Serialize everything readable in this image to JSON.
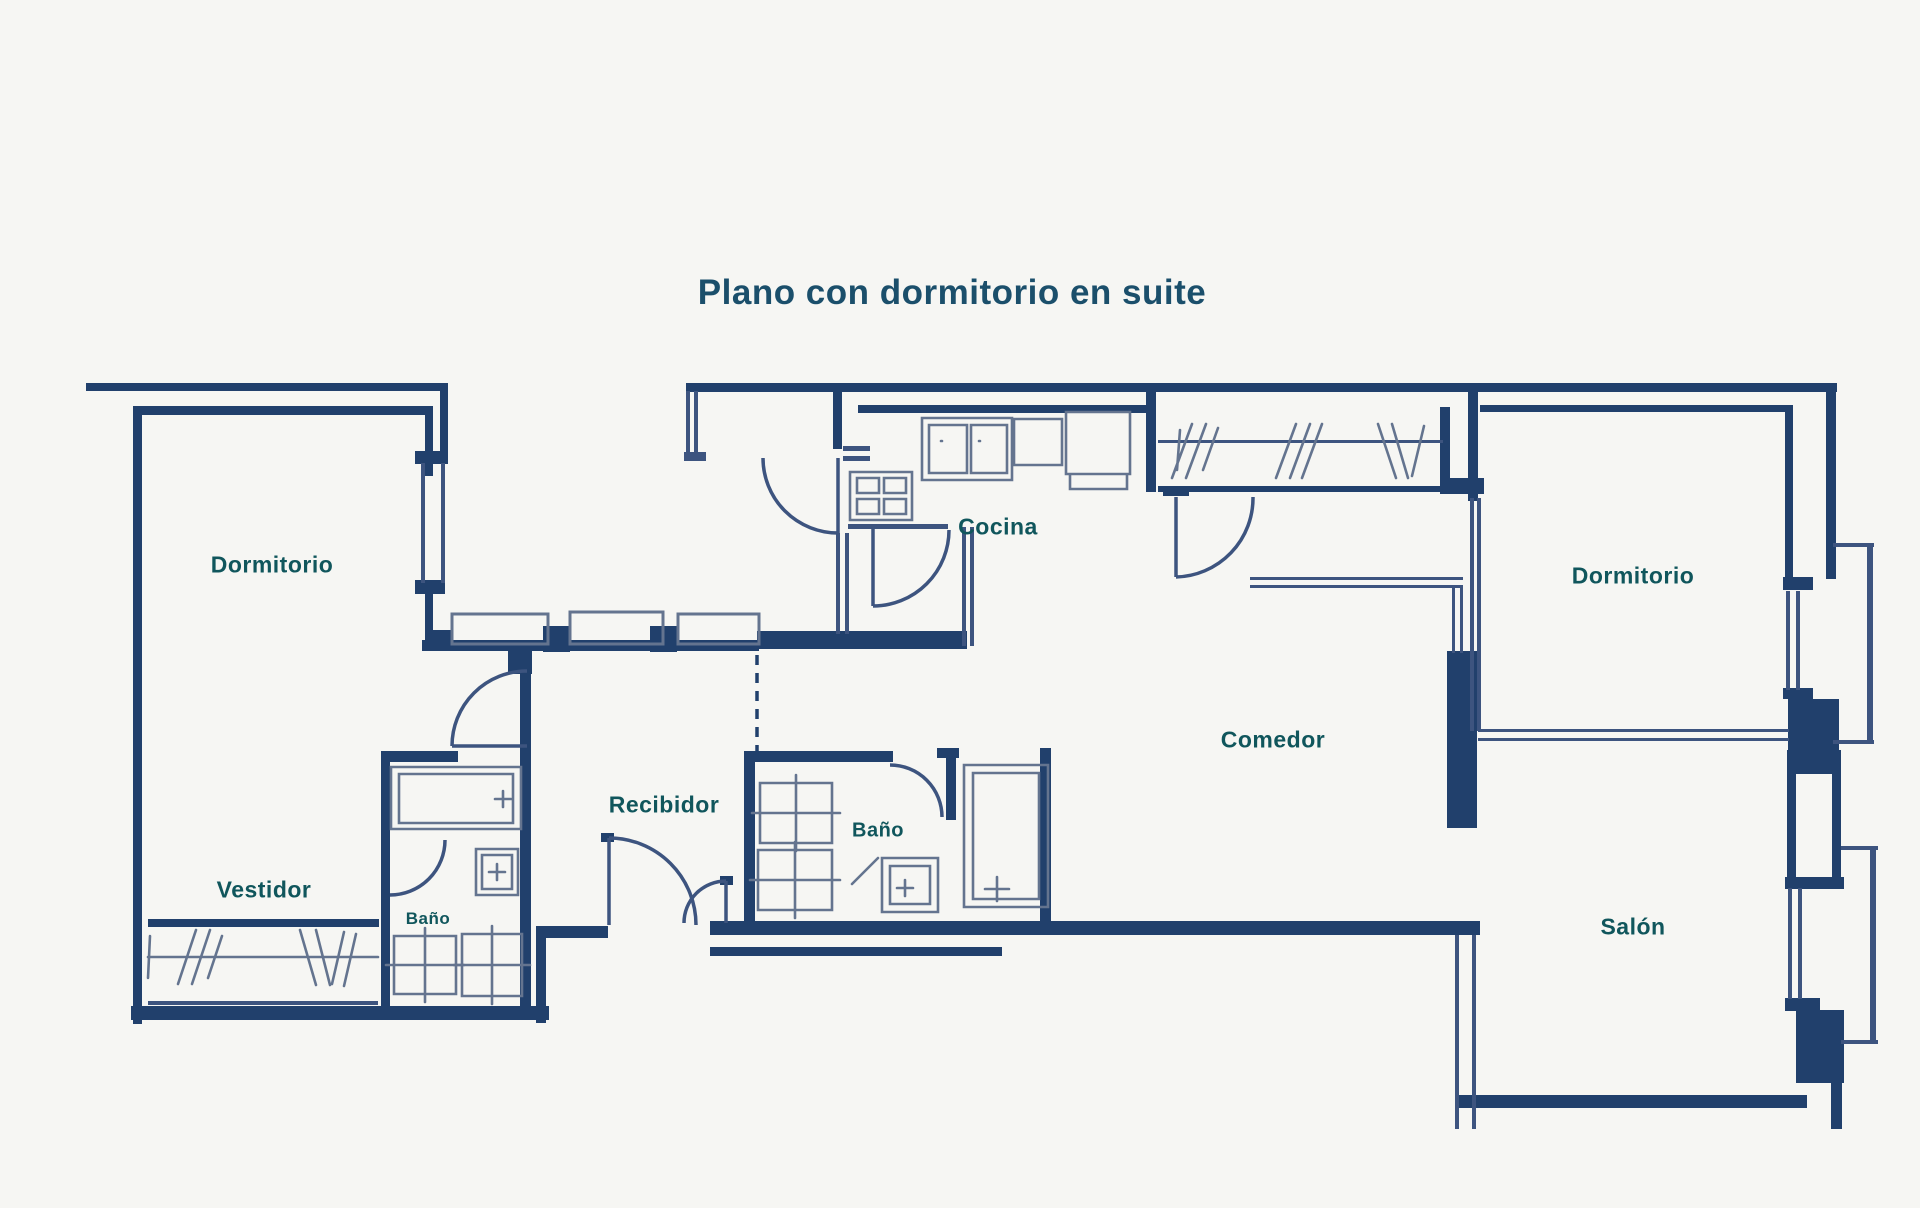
{
  "title": "Plano con dormitorio en suite",
  "rooms": {
    "dormitorio_left": {
      "label": "Dormitorio"
    },
    "vestidor": {
      "label": "Vestidor"
    },
    "bano_suite": {
      "label": "Baño"
    },
    "recibidor": {
      "label": "Recibidor"
    },
    "bano_main": {
      "label": "Baño"
    },
    "cocina": {
      "label": "Cocina"
    },
    "comedor": {
      "label": "Comedor"
    },
    "dormitorio_right": {
      "label": "Dormitorio"
    },
    "salon": {
      "label": "Salón"
    }
  },
  "colors": {
    "background": "#f6f6f3",
    "wall": "#21406c",
    "partition": "#3d547f",
    "fixture": "#64748f",
    "label_text": "#10565c",
    "title_text": "#1b4f6b"
  }
}
